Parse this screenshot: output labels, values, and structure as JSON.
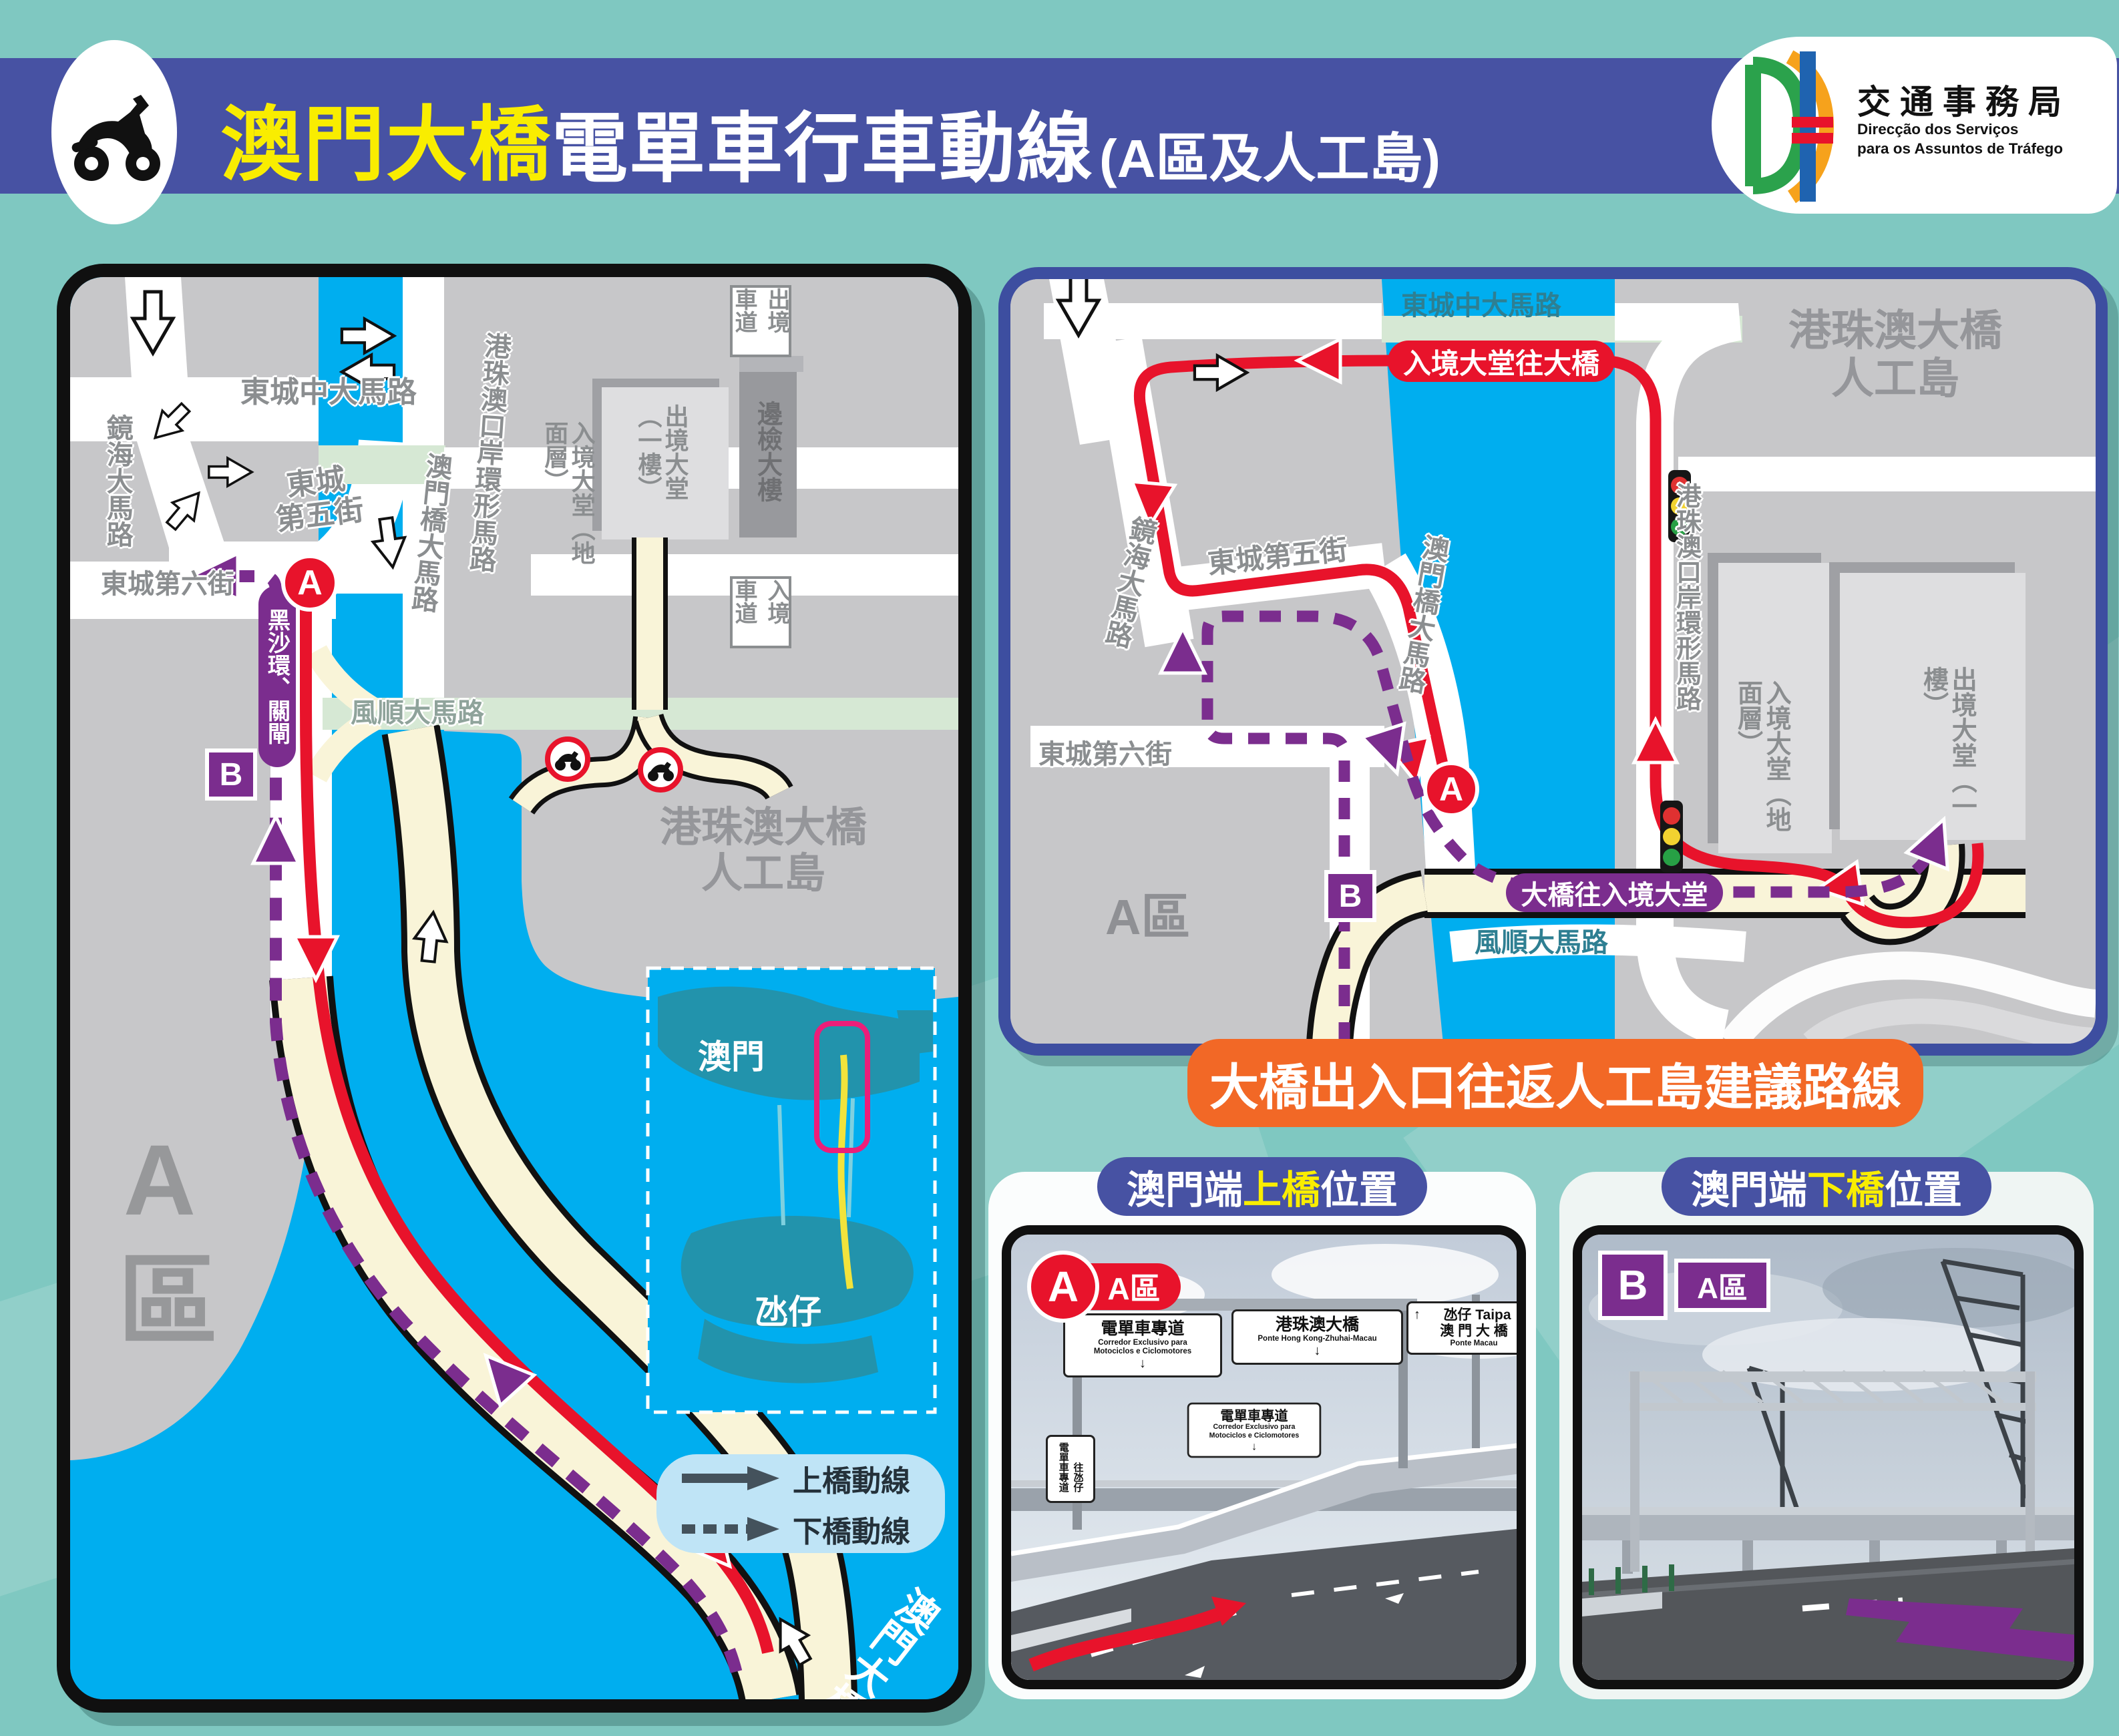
{
  "colors": {
    "route_red": "#E8132B",
    "route_purple": "#7B2D8E",
    "water": "#00AEEF",
    "header_blue": "#4752A3",
    "title_yellow": "#F9ED00",
    "banner_orange": "#F26826",
    "teal_bg": "#7FC8C1"
  },
  "header": {
    "title_bridge": "澳門大橋",
    "title_rest": "電單車行車動線",
    "title_suffix": "(A區及人工島)",
    "logo_cn": "交通事務局",
    "logo_pt1": "Direcção dos Serviços",
    "logo_pt2": "para os Assuntos de Tráfego"
  },
  "left_map": {
    "roads": {
      "dongcheng_central": "東城中大馬路",
      "jinghai": "鏡海大馬路",
      "dongcheng5": "東城\n第五街",
      "aomenqiao": "澳門橋大馬路",
      "dongcheng6": "東城第六街",
      "ring_road": "港珠澳口岸環形馬路",
      "fengshun": "風順大馬路",
      "bridge_name": "澳門大橋"
    },
    "labels": {
      "exit_lane": "出境車道",
      "entry_lane": "入境車道",
      "arrival_hall": "入境大堂（地面層）",
      "departure_hall": "出境大堂（一樓）",
      "border_building": "邊檢大樓",
      "island_name": "港珠澳大橋\n人工島",
      "zone_a": "A區",
      "heisha": "黑沙環、關閘"
    },
    "markers": {
      "a": "A",
      "b": "B"
    },
    "inset": {
      "macau": "澳門",
      "taipa": "氹仔"
    },
    "legend": {
      "up": "上橋動線",
      "down": "下橋動線"
    }
  },
  "right_map": {
    "roads": {
      "dongcheng_central": "東城中大馬路",
      "jinghai": "鏡海大馬路",
      "dongcheng5": "東城第五街",
      "aomenqiao": "澳門橋大馬路",
      "dongcheng6": "東城第六街",
      "ring_road": "港珠澳口岸環形馬路",
      "fengshun": "風順大馬路"
    },
    "labels": {
      "red_pill": "入境大堂往大橋",
      "purple_pill": "大橋往入境大堂",
      "zone_a": "A區",
      "island_name": "港珠澳大橋\n人工島",
      "arrival_hall": "入境大堂（地面層）",
      "departure_hall": "出境大堂（一樓）"
    },
    "markers": {
      "a": "A",
      "b": "B"
    }
  },
  "banner": {
    "text": "大橋出入口往返人工島建議路線"
  },
  "photos": {
    "a": {
      "head_pre": "澳門端",
      "head_mid": "上橋",
      "head_post": "位置",
      "marker": "A",
      "zone": "A區",
      "sign1_cn": "電單車專道",
      "sign1_pt1": "Corredor Exclusivo para",
      "sign1_pt2": "Motociclos e Ciclomotores",
      "sign1_arrow": "↓",
      "sign2_cn": "港珠澳大橋",
      "sign2_pt": "Ponte Hong Kong-Zhuhai-Macau",
      "sign2_arrow": "↓",
      "sign3_arrow": "↑",
      "sign3_l1": "氹仔  Taipa",
      "sign3_l2": "澳 門 大 橋",
      "sign3_l3": "Ponte Macau",
      "sign4_cn": "電單車專道",
      "sign4_pt1": "Corredor Exclusivo para",
      "sign4_pt2": "Motociclos e Ciclomotores",
      "sign4_arrow": "↓",
      "sign5_l1": "電單車專道",
      "sign5_l2": "往氹仔"
    },
    "b": {
      "head_pre": "澳門端",
      "head_mid": "下橋",
      "head_post": "位置",
      "marker": "B",
      "zone": "A區"
    }
  }
}
